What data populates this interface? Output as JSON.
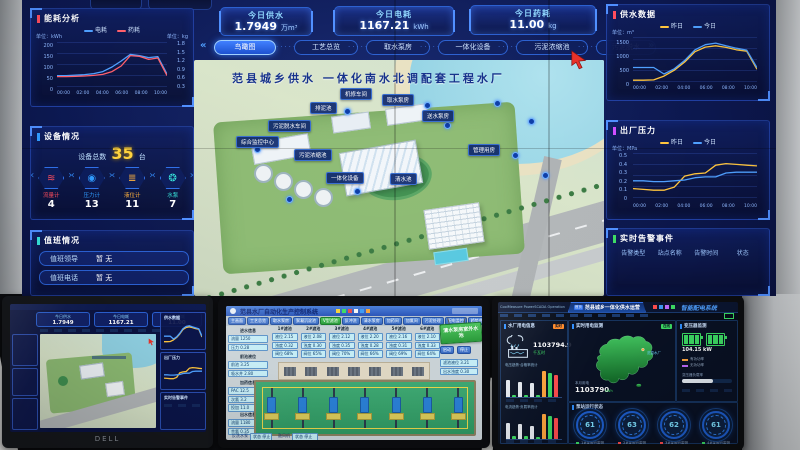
{
  "wall": {
    "stats": [
      {
        "label": "今日供水",
        "value": "1.7949",
        "unit": "万m³"
      },
      {
        "label": "今日电耗",
        "value": "1167.21",
        "unit": "kWh"
      },
      {
        "label": "今日药耗",
        "value": "11.00",
        "unit": "kg"
      }
    ],
    "nav": {
      "prev": "«",
      "next": "»",
      "tabs": [
        "鸟瞰图",
        "工艺总览",
        "取水泵房",
        "一体化设备",
        "污泥浓缩池",
        "污泥脱水"
      ]
    },
    "x_ticks": [
      "00:00",
      "02:00",
      "04:00",
      "06:00",
      "08:00",
      "10:00"
    ],
    "energy": {
      "title": "能耗分析",
      "legend": [
        {
          "label": "电耗",
          "color": "#4fa0ff"
        },
        {
          "label": "药耗",
          "color": "#ff5f6b"
        }
      ],
      "left_unit": "单位：kWh",
      "right_unit": "单位：kg",
      "left_ticks": "200\n150\n100\n50\n0",
      "right_ticks": "1.8\n1.5\n1.2\n0.9\n0.6\n0.3"
    },
    "devices": {
      "title": "设备情况",
      "total_label": "设备总数",
      "total_value": "35",
      "total_unit": "台",
      "items": [
        {
          "label": "流量计",
          "value": "4",
          "color": "#ff4d5e",
          "glyph": "≋"
        },
        {
          "label": "压力计",
          "value": "13",
          "color": "#2f9bff",
          "glyph": "◉"
        },
        {
          "label": "液位计",
          "value": "11",
          "color": "#ffb13d",
          "glyph": "≣"
        },
        {
          "label": "水泵",
          "value": "7",
          "color": "#35e0d8",
          "glyph": "❂"
        }
      ]
    },
    "duty": {
      "title": "值班情况",
      "rows": [
        {
          "label": "值班领导",
          "value": "暂 无"
        },
        {
          "label": "值班电话",
          "value": "暂 无"
        }
      ]
    },
    "supply": {
      "title": "供水数据",
      "unit": "单位：m³",
      "legend": [
        {
          "label": "昨日",
          "color": "#ffc53d"
        },
        {
          "label": "今日",
          "color": "#4fa0ff"
        }
      ],
      "y_ticks": "1500\n1000\n500\n0"
    },
    "pressure": {
      "title": "出厂压力",
      "unit": "单位：MPa",
      "legend": [
        {
          "label": "昨日",
          "color": "#ffc53d"
        },
        {
          "label": "今日",
          "color": "#4fa0ff"
        }
      ],
      "y_ticks": "0.5\n0.4\n0.3\n0.2\n0.1\n0"
    },
    "alarms": {
      "title": "实时告警事件",
      "headers": [
        "告警类型",
        "站点名称",
        "告警时间",
        "状态"
      ]
    },
    "map": {
      "title": "范县城乡供水 一体化南水北调配套工程水厂",
      "labels": [
        "排泥池",
        "机修车间",
        "取水泵房",
        "送水泵房",
        "污泥脱水车间",
        "综合监控中心",
        "污泥浓缩池",
        "管理用房",
        "一体化设备",
        "清水池"
      ]
    }
  },
  "charts": {
    "energy": {
      "min": 0,
      "max": 210,
      "series": [
        {
          "color": "#4fa0ff",
          "values": [
            52,
            52,
            54,
            57,
            62,
            72,
            95,
            125,
            158,
            152,
            142,
            147,
            60
          ]
        },
        {
          "color": "#ff5f6b",
          "values": [
            47,
            47,
            48,
            50,
            53,
            58,
            72,
            100,
            152,
            148,
            133,
            140,
            52
          ]
        }
      ]
    },
    "supply": {
      "min": 0,
      "max": 1550,
      "series": [
        {
          "color": "#ffc53d",
          "values": [
            30,
            30,
            40,
            180,
            400,
            700,
            1080,
            1250,
            1300,
            1240,
            1150,
            1100,
            430
          ]
        },
        {
          "color": "#4fa0ff",
          "values": [
            500,
            500,
            500,
            260,
            450,
            760,
            1150,
            1340,
            1400,
            1300,
            1210,
            1140,
            490
          ]
        }
      ]
    },
    "pressure": {
      "min": 0,
      "max": 0.55,
      "series": [
        {
          "color": "#ffc53d",
          "values": [
            0.12,
            0.11,
            0.1,
            0.1,
            0.14,
            0.28,
            0.31,
            0.32,
            0.42,
            0.44,
            0.43,
            0.42,
            0.41
          ]
        },
        {
          "color": "#4fa0ff",
          "values": [
            0.22,
            0.22,
            0.21,
            0.21,
            0.22,
            0.23,
            0.26,
            0.27,
            0.27,
            0.32,
            0.33,
            0.33,
            0.33
          ]
        }
      ]
    },
    "bars1": {
      "max": 100,
      "bars": [
        {
          "v": 62,
          "c": "#e8ecf2"
        },
        {
          "v": 7,
          "c": "#3ddc64"
        },
        {
          "v": 55,
          "c": "#e8ecf2"
        },
        {
          "v": 8,
          "c": "#3ddc64"
        },
        {
          "v": 50,
          "c": "#e8ecf2"
        },
        {
          "v": 7,
          "c": "#3ddc64"
        },
        {
          "v": 92,
          "c": "#ffa53d"
        },
        {
          "v": 86,
          "c": "#3ddc64"
        },
        {
          "v": 78,
          "c": "#ff4d4d"
        }
      ]
    },
    "bars2": {
      "max": 100,
      "bars": [
        {
          "v": 58,
          "c": "#e8ecf2"
        },
        {
          "v": 9,
          "c": "#3ddc64"
        },
        {
          "v": 52,
          "c": "#e8ecf2"
        },
        {
          "v": 9,
          "c": "#3ddc64"
        },
        {
          "v": 46,
          "c": "#e8ecf2"
        },
        {
          "v": 8,
          "c": "#3ddc64"
        },
        {
          "v": 90,
          "c": "#ffa53d"
        },
        {
          "v": 82,
          "c": "#3ddc64"
        },
        {
          "v": 74,
          "c": "#ff4d4d"
        }
      ]
    }
  },
  "monitors": {
    "left": {
      "brand": "DELL"
    },
    "middle": {
      "title": "范县水厂自动化生产控制系统",
      "tabs": [
        "主画面",
        "工艺总览",
        "取水泵房",
        "絮凝沉淀池",
        "V型滤池",
        "反冲洗",
        "清水泵房",
        "加药间",
        "加氯间",
        "污泥处理",
        "配电监控",
        "趋势曲线",
        "报警查询"
      ],
      "active_index": 4,
      "sign": "清水泵房室外水池",
      "buttons": [
        "启动",
        "停止"
      ],
      "top_groups": [
        {
          "title": "1#滤池",
          "rows": [
            "液位 2.15",
            "浊度 0.32",
            "阀位 68%"
          ]
        },
        {
          "title": "2#滤池",
          "rows": [
            "液位 2.08",
            "浊度 0.30",
            "阀位 65%"
          ]
        },
        {
          "title": "3#滤池",
          "rows": [
            "液位 2.12",
            "浊度 0.35",
            "阀位 70%"
          ]
        },
        {
          "title": "4#滤池",
          "rows": [
            "液位 2.20",
            "浊度 0.28",
            "阀位 66%"
          ]
        },
        {
          "title": "5#滤池",
          "rows": [
            "液位 2.16",
            "浊度 0.31",
            "阀位 69%"
          ]
        },
        {
          "title": "6#滤池",
          "rows": [
            "液位 2.10",
            "浊度 0.33",
            "阀位 64%"
          ]
        }
      ],
      "left_groups": [
        {
          "title": "进水信息",
          "rows": [
            "流量 1250",
            "压力 0.28"
          ]
        },
        {
          "title": "前池液位",
          "rows": [
            "前池 3.25",
            "吸水井 2.80"
          ]
        },
        {
          "title": "加药信息",
          "rows": [
            "PAC 12.5",
            "次氯 3.2",
            "投加 11.0"
          ]
        },
        {
          "title": "出水信息",
          "rows": [
            "流量 1180",
            "余氯 0.35"
          ]
        }
      ],
      "bottom_groups": [
        {
          "title": "反洗水泵",
          "rows": [
            "状态 停止"
          ]
        },
        {
          "title": "鼓风机",
          "rows": [
            "状态 停止"
          ]
        }
      ],
      "right_rows": [
        "滤池液位 3.21",
        "出水浊度 0.30"
      ]
    },
    "right": {
      "brand": "CoolMeasure PowerSCADA Operation",
      "home": "首页",
      "nav_title": "范县城乡一体化供水运营",
      "system_title": "智能配电系统",
      "left_panel": {
        "title": "水厂用电信息",
        "tag": "实时",
        "value": "1103794.9",
        "unit": "千瓦时",
        "chart1_title": "电压趋势·合格率统计",
        "chart2_title": "电流趋势·负载率统计"
      },
      "map_panel": {
        "title": "实时用电监测",
        "tag": "在线",
        "marker": "范县水厂",
        "label": "本月用电",
        "value": "1103790",
        "unit": "kWh"
      },
      "gauge_panel": {
        "title": "泵站运行状态",
        "gauges": [
          {
            "value": "61",
            "label": "1#泵运行监测",
            "color": "#3ddc64"
          },
          {
            "value": "63",
            "label": "2#泵运行监测",
            "color": "#ff4d4d"
          },
          {
            "value": "62",
            "label": "3#泵运行监测",
            "color": "#ff4d4d"
          },
          {
            "value": "61",
            "label": "4#泵运行监测",
            "color": "#3ddc64"
          }
        ]
      },
      "right_panel": {
        "title": "变压器监测",
        "value": "104.15 kW",
        "legend": [
          {
            "label": "有功功率",
            "color": "#ffa53d"
          },
          {
            "label": "无功功率",
            "color": "#c06bff"
          }
        ],
        "load_label": "变压器负载率",
        "load_pct": 62
      }
    }
  }
}
